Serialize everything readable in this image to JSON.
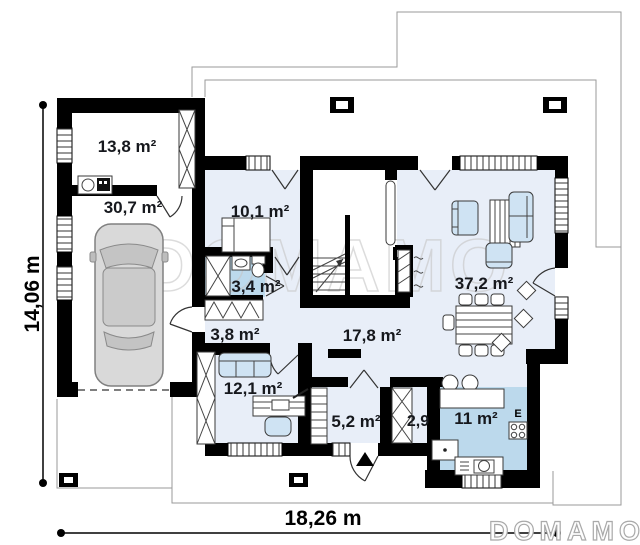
{
  "plan": {
    "watermark_center": "DOMAMO",
    "watermark_corner": "DOMAMO",
    "appliance_label": "E",
    "dimensions": {
      "height": "14,06 m",
      "width": "18,26 m"
    },
    "rooms": [
      {
        "name": "utility-room",
        "area": "13,8 m²"
      },
      {
        "name": "garage",
        "area": "30,7 m²"
      },
      {
        "name": "bedroom",
        "area": "10,1 m²"
      },
      {
        "name": "bathroom",
        "area": "3,4 m²"
      },
      {
        "name": "corridor",
        "area": "3,8 m²"
      },
      {
        "name": "office",
        "area": "12,1 m²"
      },
      {
        "name": "hall",
        "area": "17,8 m²"
      },
      {
        "name": "living-room",
        "area": "37,2 m²"
      },
      {
        "name": "vestibule",
        "area": "5,2 m²"
      },
      {
        "name": "pantry",
        "area": "2,9"
      },
      {
        "name": "kitchen",
        "area": "11 m²"
      }
    ],
    "colors": {
      "wall": "#000000",
      "floor_light": "#e8eef8",
      "floor_wet": "#bcd9ec",
      "furniture": "#cfe3f3",
      "car_body": "#d9d9d9"
    }
  }
}
